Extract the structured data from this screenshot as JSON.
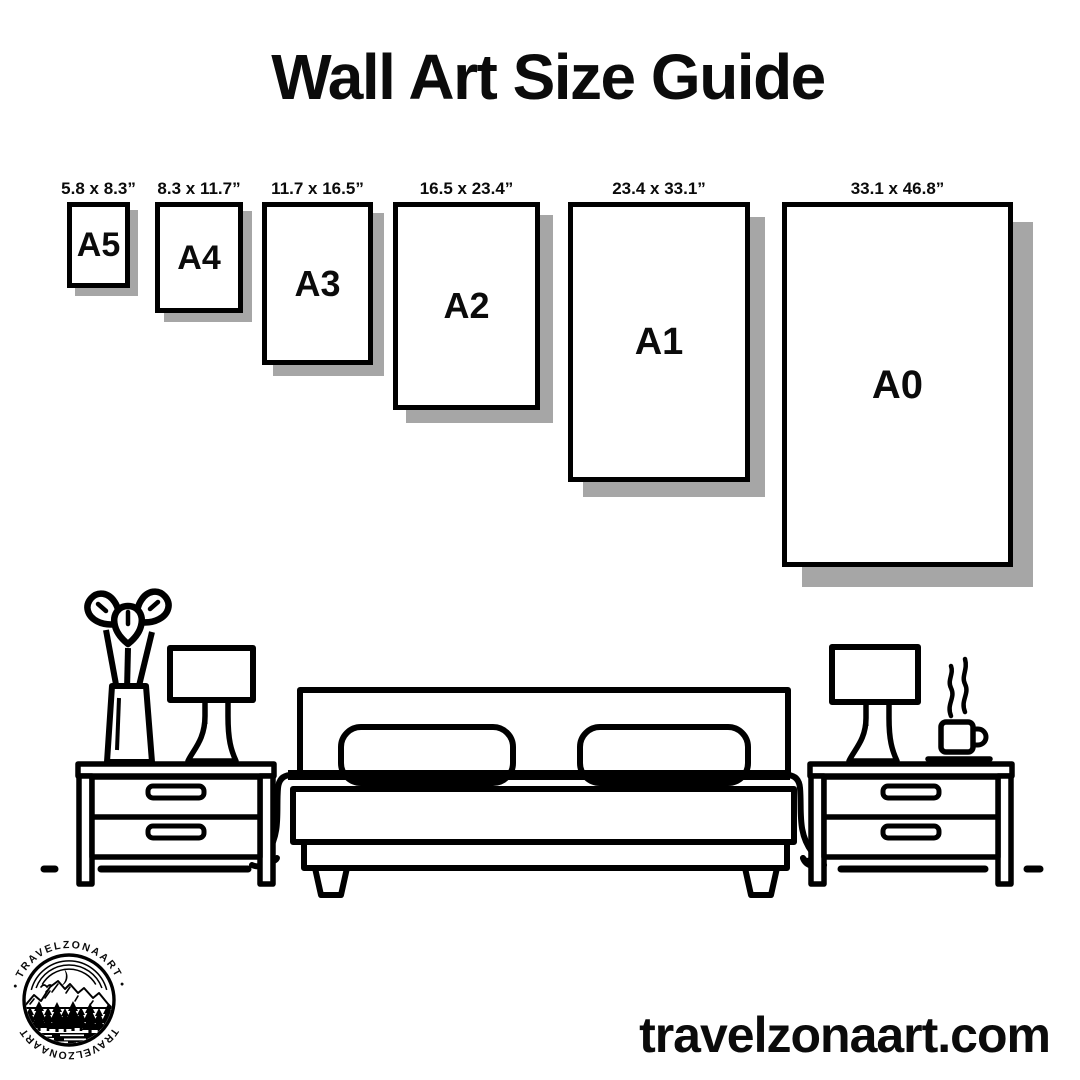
{
  "title": "Wall Art Size Guide",
  "papers": [
    {
      "name": "A5",
      "dim_label": "5.8 x 8.3”"
    },
    {
      "name": "A4",
      "dim_label": "8.3 x 11.7”"
    },
    {
      "name": "A3",
      "dim_label": "11.7 x 16.5”"
    },
    {
      "name": "A2",
      "dim_label": "16.5 x 23.4”"
    },
    {
      "name": "A1",
      "dim_label": "23.4 x 33.1”"
    },
    {
      "name": "A0",
      "dim_label": "33.1 x 46.8”"
    }
  ],
  "illustration": {
    "icons": [
      "potted-plant-icon",
      "table-lamp-icon",
      "nightstand-icon",
      "double-bed-icon",
      "coffee-cup-icon",
      "steam-icon",
      "floor-line"
    ]
  },
  "logo": {
    "text_top": "• TRAVELZONAART •",
    "text_bottom": "TRAVELZONAART"
  },
  "website": "travelzonaart.com",
  "colors": {
    "ink": "#000000",
    "paper_shadow": "#a6a6a6",
    "background": "#ffffff"
  }
}
